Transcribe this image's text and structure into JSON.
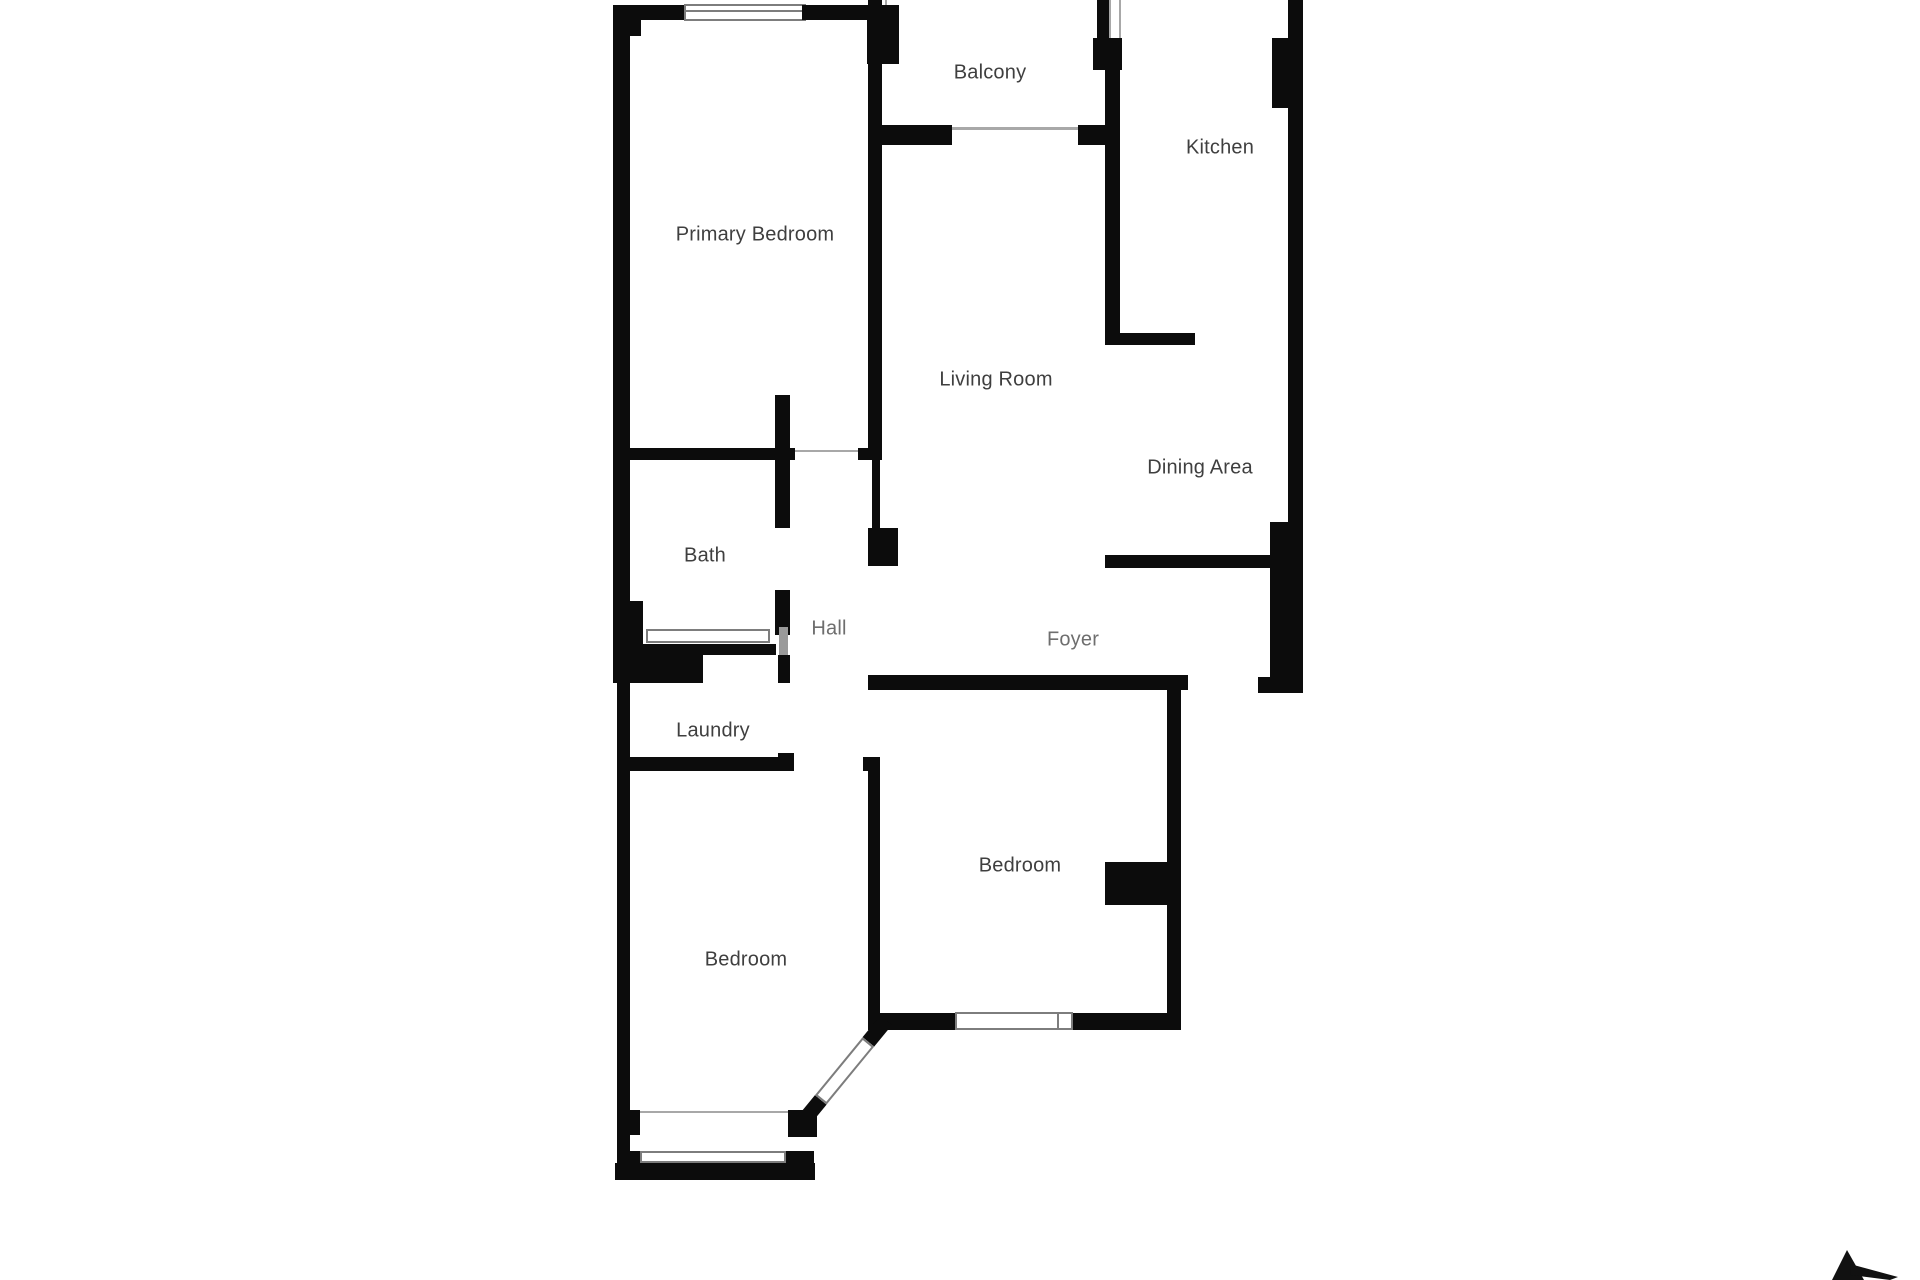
{
  "title": "Apartment floor plan",
  "rooms": [
    {
      "id": "balcony",
      "label": "Balcony"
    },
    {
      "id": "kitchen",
      "label": "Kitchen"
    },
    {
      "id": "primary-bedroom",
      "label": "Primary Bedroom"
    },
    {
      "id": "living-room",
      "label": "Living Room"
    },
    {
      "id": "dining-area",
      "label": "Dining Area"
    },
    {
      "id": "bath",
      "label": "Bath"
    },
    {
      "id": "hall",
      "label": "Hall"
    },
    {
      "id": "foyer",
      "label": "Foyer"
    },
    {
      "id": "laundry",
      "label": "Laundry"
    },
    {
      "id": "bedroom-right",
      "label": "Bedroom"
    },
    {
      "id": "bedroom-left",
      "label": "Bedroom"
    }
  ],
  "colors": {
    "wall": "#0c0c0c",
    "label": "#3f3f3f",
    "label_faded": "#6e6e6e",
    "frame": "#7d7d7d",
    "door": "#9a9a9a",
    "background": "#ffffff",
    "north_arrow": "#111111"
  }
}
